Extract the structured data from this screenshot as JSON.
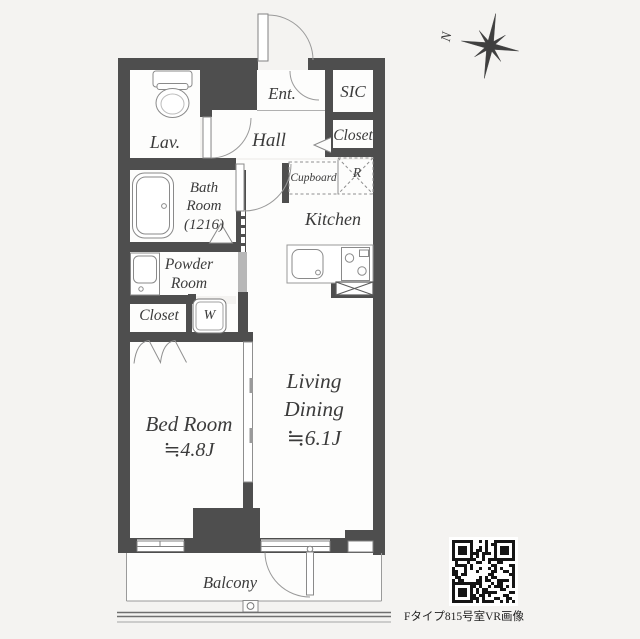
{
  "rooms": {
    "lav": {
      "label": "Lav."
    },
    "ent": {
      "label": "Ent."
    },
    "sic": {
      "label": "SIC"
    },
    "closet_upper": {
      "label": "Closet"
    },
    "hall": {
      "label": "Hall"
    },
    "bath": {
      "l1": "Bath",
      "l2": "Room",
      "l3": "(1216)"
    },
    "cupboard": {
      "label": "Cupboard"
    },
    "fridge": {
      "label": "R"
    },
    "kitchen": {
      "label": "Kitchen"
    },
    "powder": {
      "l1": "Powder",
      "l2": "Room"
    },
    "closet_lower": {
      "label": "Closet"
    },
    "washer": {
      "label": "W"
    },
    "bedroom": {
      "l1": "Bed Room",
      "l2": "≒4.8J"
    },
    "living": {
      "l1": "Living",
      "l2": "Dining",
      "l3": "≒6.1J"
    },
    "balcony": {
      "label": "Balcony"
    }
  },
  "compass": {
    "label": "N"
  },
  "qr": {
    "caption": "Fタイプ815号室VR画像"
  },
  "colors": {
    "wall": "#4e4e4e",
    "bg": "#f4f3f1",
    "room": "#fdfdfc",
    "line": "#8f8f8f",
    "text": "#3b3b3b"
  }
}
